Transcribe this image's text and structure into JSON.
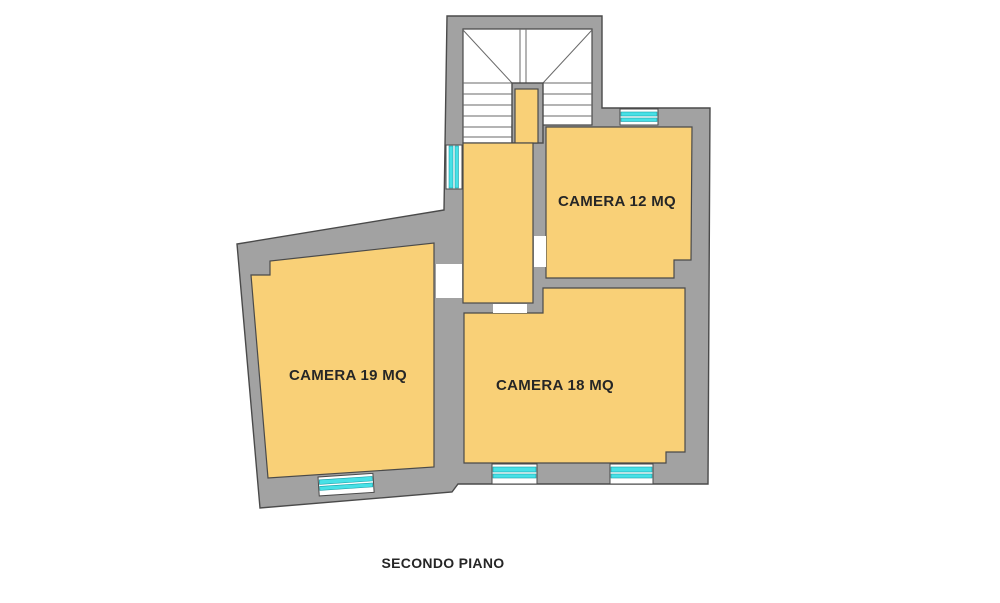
{
  "floor_plan": {
    "title": "SECONDO PIANO",
    "rooms": [
      {
        "id": "camera-12",
        "label": "CAMERA 12 MQ"
      },
      {
        "id": "camera-19",
        "label": "CAMERA 19 MQ"
      },
      {
        "id": "camera-18",
        "label": "CAMERA 18 MQ"
      }
    ]
  },
  "colors": {
    "background": "#ffffff",
    "wall_fill": "#a2a2a2",
    "room_fill": "#f9d077",
    "stair_fill": "#ffffff",
    "window_glass": "#47e1e6",
    "outline": "#4a4a4a",
    "label_text": "#262626"
  }
}
